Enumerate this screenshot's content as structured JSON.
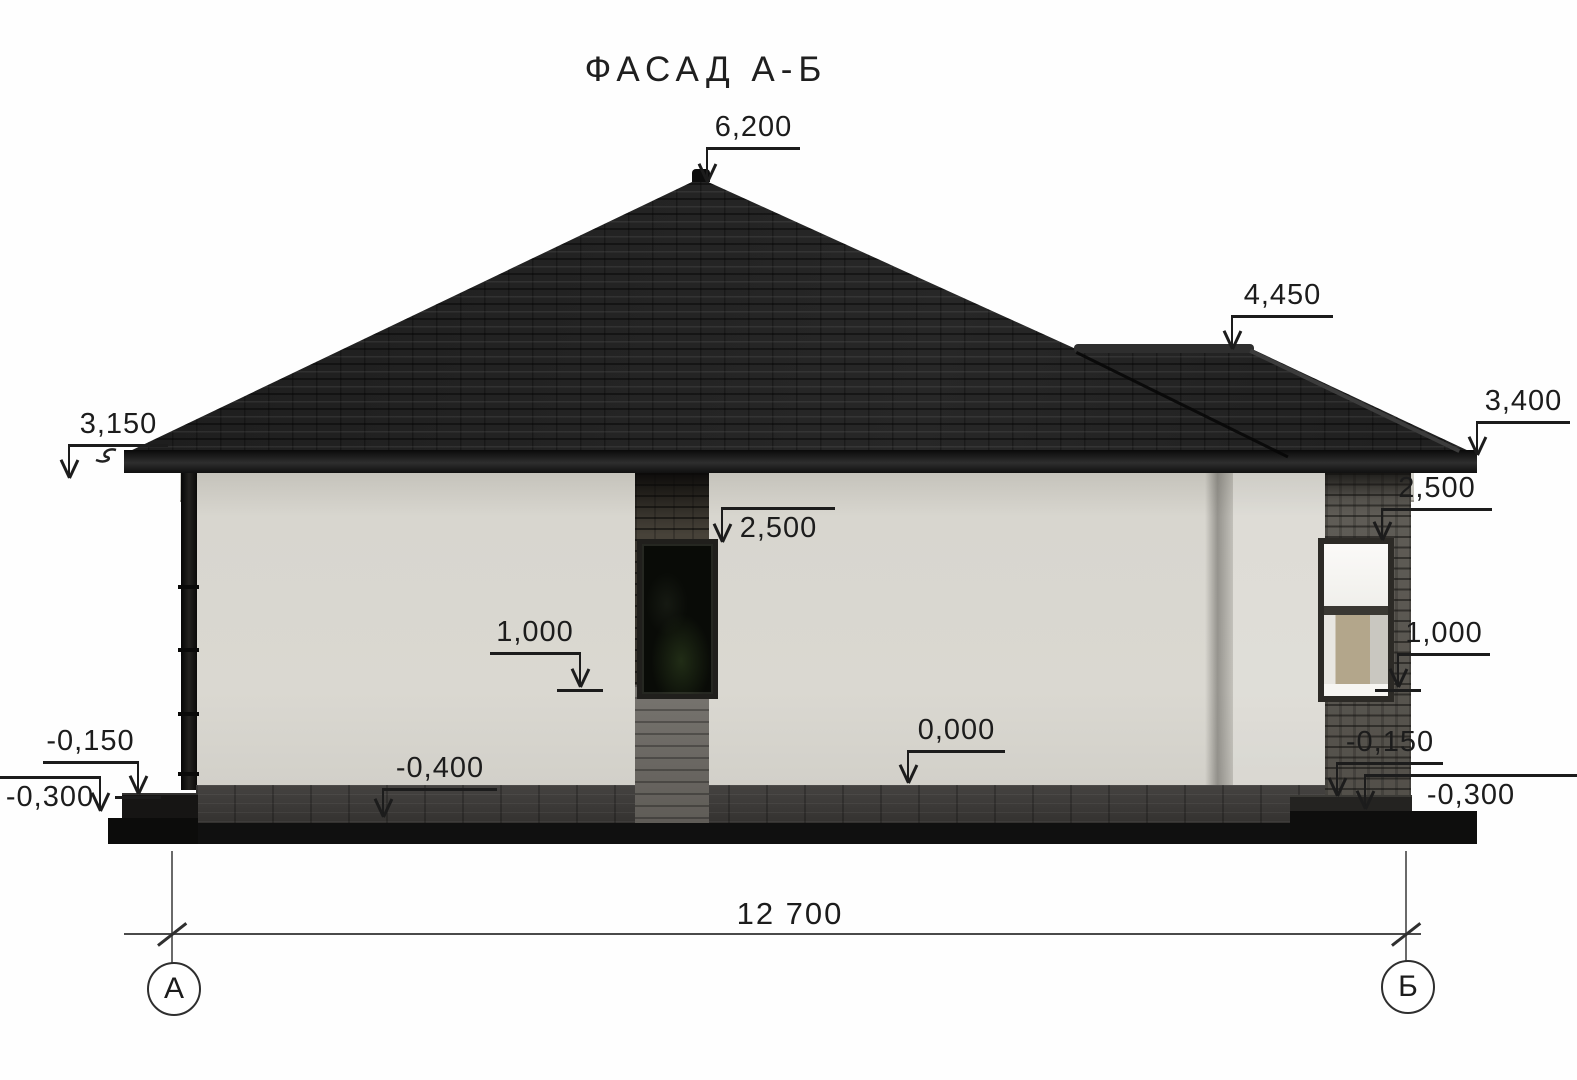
{
  "title": "ФАСАД А-Б",
  "annotations": {
    "elevation_marks": [
      {
        "name": "peak",
        "label": "6,200",
        "x1": 707,
        "x2": 800,
        "shelf_y": 147,
        "drop": "left",
        "tip_y": 182,
        "text": "above",
        "tick": false
      },
      {
        "name": "porch-ridge",
        "label": "4,450",
        "x1": 1232,
        "x2": 1333,
        "shelf_y": 315,
        "drop": "left",
        "tip_y": 349,
        "text": "above",
        "tick": false
      },
      {
        "name": "right-eave",
        "label": "3,400",
        "x1": 1477,
        "x2": 1570,
        "shelf_y": 421,
        "drop": "left",
        "tip_y": 455,
        "text": "above",
        "tick": false
      },
      {
        "name": "left-eave",
        "label": "3,150",
        "x1": 69,
        "x2": 168,
        "shelf_y": 444,
        "drop": "left",
        "tip_y": 478,
        "text": "above",
        "tick": false
      },
      {
        "name": "mid-window-top",
        "label": "2,500",
        "x1": 722,
        "x2": 835,
        "shelf_y": 507,
        "drop": "left",
        "tip_y": 542,
        "text": "below",
        "tick": false
      },
      {
        "name": "right-window-top",
        "label": "2,500",
        "x1": 1382,
        "x2": 1492,
        "shelf_y": 508,
        "drop": "left",
        "tip_y": 540,
        "text": "above",
        "tick": false
      },
      {
        "name": "mid-wall",
        "label": "1,000",
        "x1": 490,
        "x2": 580,
        "shelf_y": 652,
        "drop": "right",
        "tip_y": 687,
        "text": "above",
        "tick": true
      },
      {
        "name": "right-wall",
        "label": "1,000",
        "x1": 1398,
        "x2": 1490,
        "shelf_y": 653,
        "drop": "left",
        "tip_y": 687,
        "text": "above",
        "tick": true
      },
      {
        "name": "floor-level",
        "label": "0,000",
        "x1": 908,
        "x2": 1005,
        "shelf_y": 750,
        "drop": "left",
        "tip_y": 783,
        "text": "above",
        "tick": false
      },
      {
        "name": "ground-level",
        "label": "-0,400",
        "x1": 383,
        "x2": 497,
        "shelf_y": 788,
        "drop": "left",
        "tip_y": 817,
        "text": "above",
        "tick": false
      },
      {
        "name": "left-step-top",
        "label": "-0,150",
        "x1": 43,
        "x2": 138,
        "shelf_y": 761,
        "drop": "right",
        "tip_y": 794,
        "text": "above",
        "tick": true
      },
      {
        "name": "left-step-bottom",
        "label": "-0,300",
        "x1": 0,
        "x2": 100,
        "shelf_y": 776,
        "drop": "right",
        "tip_y": 811,
        "text": "below",
        "tick": false
      },
      {
        "name": "right-step-top",
        "label": "-0,150",
        "x1": 1337,
        "x2": 1443,
        "shelf_y": 762,
        "drop": "left",
        "tip_y": 796,
        "text": "above",
        "tick": false
      },
      {
        "name": "right-step-bottom",
        "label": "-0,300",
        "x1": 1365,
        "x2": 1577,
        "shelf_y": 774,
        "drop": "left",
        "tip_y": 809,
        "text": "below",
        "tick": false
      }
    ],
    "dimension": {
      "label": "12 700"
    },
    "axes": [
      {
        "name": "axis-a",
        "label": "А"
      },
      {
        "name": "axis-b",
        "label": "Б"
      }
    ]
  },
  "colors": {
    "roof": "#1d1d1d",
    "fascia": "#101010",
    "soffit": "#c9c7bf",
    "wall": "#d8d6cf",
    "brick_pier": "#474239",
    "brick_column": "#615e58",
    "stone_base": "#787570",
    "paving": "#454341",
    "plinth": "#101010",
    "window_glass_dark": "#090b07",
    "window_glass_light": "#f6f5f2",
    "window_interior_tan": "#b3a68b",
    "annotation": "#1c1c1c"
  }
}
